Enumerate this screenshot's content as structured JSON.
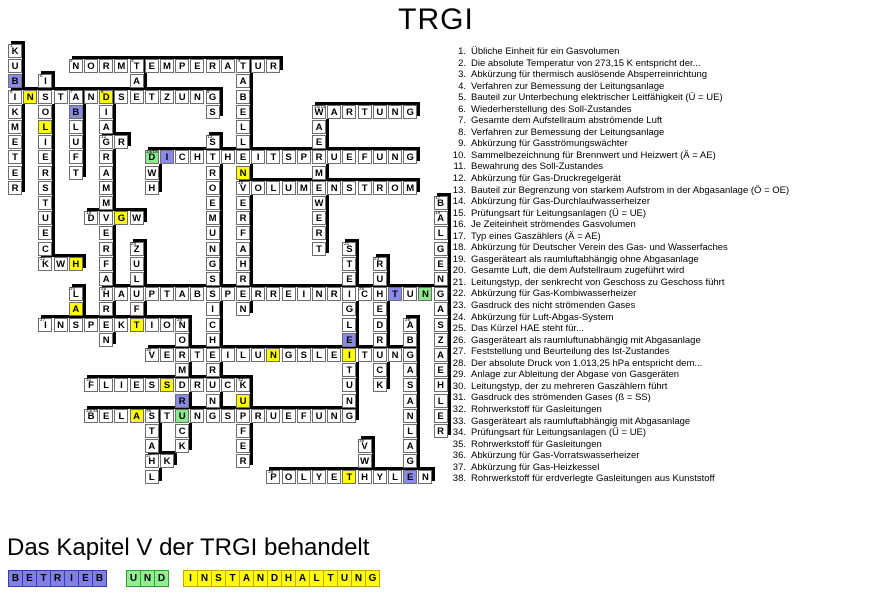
{
  "title": "TRGI",
  "footer": {
    "heading": "Das Kapitel V der TRGI behandelt"
  },
  "colors": {
    "cell_blue": "#8a8ae8",
    "cell_green": "#8ce88c",
    "cell_yellow": "#ffff00",
    "solution_blue": "#8080e8",
    "solution_green": "#90ee90",
    "solution_yellow": "#ffff00",
    "shadow": "#000000"
  },
  "grid": {
    "origin": {
      "x": 8,
      "y": 44
    },
    "pitch": 15.2,
    "cell_size": 14,
    "words": [
      {
        "label": "1",
        "dir": "v",
        "col": 0,
        "row": 0,
        "answer": "KUBIKMETER"
      },
      {
        "label": "2",
        "dir": "h",
        "col": 4,
        "row": 1,
        "answer": "NORMTEMPERATUR"
      },
      {
        "label": "3",
        "dir": "v",
        "col": 8,
        "row": 1,
        "answer": "TAE"
      },
      {
        "label": "4",
        "dir": "v",
        "col": 15,
        "row": 1,
        "answer": "TABELLENVERFAHREN"
      },
      {
        "label": "5",
        "dir": "v",
        "col": 2,
        "row": 2,
        "answer": "ISOLIERSTUECK"
      },
      {
        "label": "6",
        "dir": "h",
        "col": 0,
        "row": 3,
        "answer": "INSTANDSETZUNG"
      },
      {
        "label": "7",
        "dir": "v",
        "col": 4,
        "row": 3,
        "answer": "ABLUFT"
      },
      {
        "label": "8",
        "dir": "v",
        "col": 6,
        "row": 3,
        "answer": "DIAGRAMMVERFAHREN"
      },
      {
        "label": "9",
        "dir": "v",
        "col": 13,
        "row": 3,
        "answer": "GS"
      },
      {
        "label": "10/11",
        "dir": "v",
        "col": 20,
        "row": 4,
        "answer": "WAERMEWERT"
      },
      {
        "label": "",
        "dir": "h",
        "col": 20,
        "row": 4,
        "answer": "WARTUNG"
      },
      {
        "label": "12",
        "dir": "h",
        "col": 6,
        "row": 6,
        "answer": "GR"
      },
      {
        "label": "13",
        "dir": "v",
        "col": 13,
        "row": 6,
        "answer": "STROEMUNGSSICHERUNG"
      },
      {
        "label": "14/15",
        "dir": "v",
        "col": 9,
        "row": 7,
        "answer": "DWH"
      },
      {
        "label": "",
        "dir": "h",
        "col": 9,
        "row": 7,
        "answer": "DICHTHEITSPRUEFUNG"
      },
      {
        "label": "16",
        "dir": "h",
        "col": 15,
        "row": 9,
        "answer": "VOLUMENSTROM"
      },
      {
        "label": "17",
        "dir": "v",
        "col": 28,
        "row": 10,
        "answer": "BALGENGASZAEHLER"
      },
      {
        "label": "18",
        "dir": "h",
        "col": 5,
        "row": 11,
        "answer": "DVGW"
      },
      {
        "label": "20",
        "dir": "v",
        "col": 8,
        "row": 13,
        "answer": "ZULUFT"
      },
      {
        "label": "21",
        "dir": "v",
        "col": 22,
        "row": 13,
        "answer": "STEIGLEITUNG"
      },
      {
        "label": "22",
        "dir": "h",
        "col": 2,
        "row": 14,
        "answer": "KWH"
      },
      {
        "label": "23",
        "dir": "v",
        "col": 24,
        "row": 14,
        "answer": "RUHEDRUCK"
      },
      {
        "label": "24",
        "dir": "v",
        "col": 4,
        "row": 16,
        "answer": "LAS"
      },
      {
        "label": "25",
        "dir": "h",
        "col": 6,
        "row": 16,
        "answer": "HAUPTABSPERREINRICHTUNG"
      },
      {
        "label": "27",
        "dir": "h",
        "col": 2,
        "row": 18,
        "answer": "INSPEKTION"
      },
      {
        "label": "28",
        "dir": "v",
        "col": 11,
        "row": 18,
        "answer": "NORMDRUCK"
      },
      {
        "label": "29",
        "dir": "v",
        "col": 26,
        "row": 18,
        "answer": "ABGASANLAGE"
      },
      {
        "label": "30",
        "dir": "h",
        "col": 9,
        "row": 20,
        "answer": "VERTEILUNGSLEITUNG"
      },
      {
        "label": "31",
        "dir": "h",
        "col": 5,
        "row": 22,
        "answer": "FLIESSDRUCK"
      },
      {
        "label": "32",
        "dir": "v",
        "col": 15,
        "row": 22,
        "answer": "KUPFER"
      },
      {
        "label": "33/34",
        "dir": "h",
        "col": 5,
        "row": 24,
        "answer": "BELASTUNGSPRUEFUNG"
      },
      {
        "label": "35",
        "dir": "v",
        "col": 9,
        "row": 24,
        "answer": "STAHL"
      },
      {
        "label": "36",
        "dir": "v",
        "col": 23,
        "row": 26,
        "answer": "VWH"
      },
      {
        "label": "37",
        "dir": "h",
        "col": 9,
        "row": 27,
        "answer": "HK"
      },
      {
        "label": "38",
        "dir": "h",
        "col": 17,
        "row": 28,
        "answer": "POLYETHYLEN"
      }
    ],
    "extra_labels": [
      {
        "col": 28,
        "row": 11,
        "label": "19"
      },
      {
        "col": 23,
        "row": 16,
        "label": "26"
      }
    ],
    "colored_cells": [
      {
        "col": 0,
        "row": 2,
        "color": "blue"
      },
      {
        "col": 4,
        "row": 4,
        "color": "blue"
      },
      {
        "col": 10,
        "row": 7,
        "color": "blue"
      },
      {
        "col": 25,
        "row": 16,
        "color": "blue"
      },
      {
        "col": 22,
        "row": 19,
        "color": "blue"
      },
      {
        "col": 11,
        "row": 23,
        "color": "blue"
      },
      {
        "col": 26,
        "row": 28,
        "color": "blue"
      },
      {
        "col": 9,
        "row": 7,
        "color": "green"
      },
      {
        "col": 27,
        "row": 16,
        "color": "green"
      },
      {
        "col": 11,
        "row": 24,
        "color": "green"
      },
      {
        "col": 1,
        "row": 3,
        "color": "yellow"
      },
      {
        "col": 6,
        "row": 3,
        "color": "yellow"
      },
      {
        "col": 2,
        "row": 5,
        "color": "yellow"
      },
      {
        "col": 15,
        "row": 8,
        "color": "yellow"
      },
      {
        "col": 7,
        "row": 11,
        "color": "yellow"
      },
      {
        "col": 4,
        "row": 14,
        "color": "yellow"
      },
      {
        "col": 4,
        "row": 17,
        "color": "yellow"
      },
      {
        "col": 8,
        "row": 18,
        "color": "yellow"
      },
      {
        "col": 17,
        "row": 20,
        "color": "yellow"
      },
      {
        "col": 22,
        "row": 20,
        "color": "yellow"
      },
      {
        "col": 10,
        "row": 22,
        "color": "yellow"
      },
      {
        "col": 15,
        "row": 23,
        "color": "yellow"
      },
      {
        "col": 8,
        "row": 24,
        "color": "yellow"
      },
      {
        "col": 22,
        "row": 28,
        "color": "yellow"
      }
    ]
  },
  "clues": [
    {
      "num": "1.",
      "text": "Übliche Einheit für ein Gasvolumen"
    },
    {
      "num": "2.",
      "text": "Die absolute Temperatur von 273,15 K entspricht der..."
    },
    {
      "num": "3.",
      "text": "Abkürzung für thermisch auslösende Absperreinrichtung"
    },
    {
      "num": "4.",
      "text": "Verfahren zur Bemessung der Leitungsanlage"
    },
    {
      "num": "5.",
      "text": "Bauteil zur Unterbechung elektrischer Leitfähigkeit (Ü = UE)"
    },
    {
      "num": "6.",
      "text": "Wiederherstellung des Soll-Zustandes"
    },
    {
      "num": "7.",
      "text": "Gesamte dem Aufstellraum abströmende Luft"
    },
    {
      "num": "8.",
      "text": "Verfahren zur Bemessung der Leitungsanlage"
    },
    {
      "num": "9.",
      "text": "Abkürzung für Gasströmungswächter"
    },
    {
      "num": "10.",
      "text": "Sammelbezeichnung für Brennwert und Heizwert (Ä = AE)"
    },
    {
      "num": "11.",
      "text": "Bewahrung des Soll-Zustandes"
    },
    {
      "num": "12.",
      "text": "Abkürzung für Gas-Druckregelgerät"
    },
    {
      "num": "13.",
      "text": "Bauteil zur Begrenzung von starkem Aufstrom in der Abgasanlage (Ö = OE)"
    },
    {
      "num": "14.",
      "text": "Abkürzung für Gas-Durchlaufwasserheizer"
    },
    {
      "num": "15.",
      "text": "Prüfungsart für Leitungsanlagen (Ü = UE)"
    },
    {
      "num": "16.",
      "text": "Je Zeiteinheit strömendes Gasvolumen"
    },
    {
      "num": "17.",
      "text": "Typ eines Gaszählers (Ä = AE)"
    },
    {
      "num": "18.",
      "text": "Abkürzung für Deutscher Verein des Gas- und Wasserfaches"
    },
    {
      "num": "19.",
      "text": "Gasgeräteart als raumluftabhängig ohne Abgasanlage"
    },
    {
      "num": "20.",
      "text": "Gesamte Luft, die dem Aufstellraum zugeführt wird"
    },
    {
      "num": "21.",
      "text": "Leitungstyp, der senkrecht von Geschoss zu Geschoss führt"
    },
    {
      "num": "22.",
      "text": "Abkürzung für Gas-Kombiwasserheizer"
    },
    {
      "num": "23.",
      "text": "Gasdruck des nicht strömenden Gases"
    },
    {
      "num": "24.",
      "text": "Abkürzung für Luft-Abgas-System"
    },
    {
      "num": "25.",
      "text": "Das Kürzel HAE steht für..."
    },
    {
      "num": "26.",
      "text": "Gasgeräteart als raumluftunabhängig mit Abgasanlage"
    },
    {
      "num": "27.",
      "text": "Feststellung und Beurteilung des Ist-Zustandes"
    },
    {
      "num": "28.",
      "text": "Der absolute Druck von 1.013,25 hPa entspricht dem..."
    },
    {
      "num": "29.",
      "text": "Anlage zur Ableitung der Abgase von Gasgeräten"
    },
    {
      "num": "30.",
      "text": "Leitungstyp, der zu mehreren Gaszählern führt"
    },
    {
      "num": "31.",
      "text": "Gasdruck des strömenden Gases (ß = SS)"
    },
    {
      "num": "32.",
      "text": "Rohrwerkstoff für Gasleitungen"
    },
    {
      "num": "33.",
      "text": "Gasgeräteart als raumluftabhängig mit Abgasanlage"
    },
    {
      "num": "34.",
      "text": "Prüfungsart für Leitungsanlagen (Ü = UE)"
    },
    {
      "num": "35.",
      "text": "Rohrwerkstoff für Gasleitungen"
    },
    {
      "num": "36.",
      "text": "Abkürzung für Gas-Vorratswasserheizer"
    },
    {
      "num": "37.",
      "text": "Abkürzung für Gas-Heizkessel"
    },
    {
      "num": "38.",
      "text": "Rohrwerkstoff für erdverlegte Gasleitungen aus Kunststoff"
    }
  ],
  "solution": {
    "groups": [
      {
        "word": "BETRIEB",
        "color": "blue",
        "x": 8
      },
      {
        "word": "UND",
        "color": "green",
        "x": 126
      },
      {
        "word": "INSTANDHALTUNG",
        "color": "yellow",
        "x": 183
      }
    ]
  }
}
